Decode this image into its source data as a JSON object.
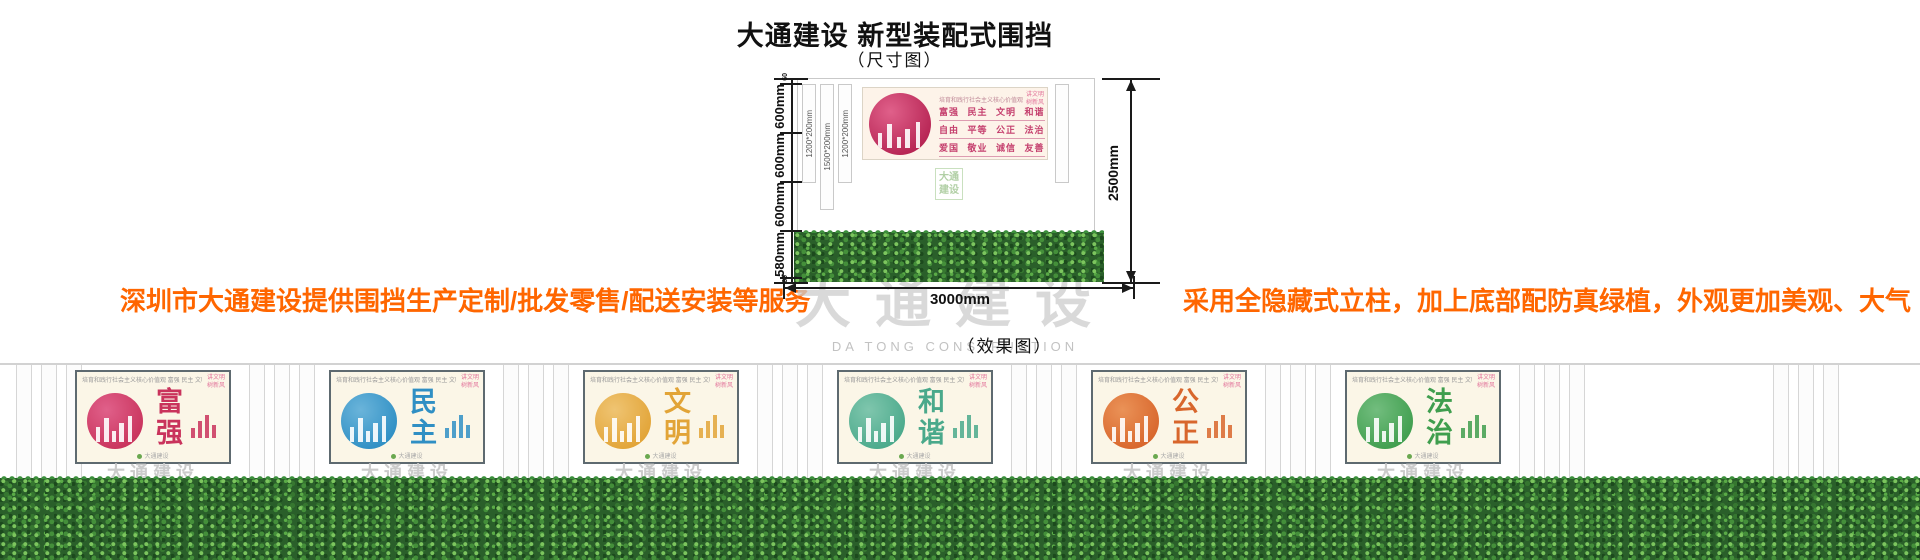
{
  "header": {
    "title": "大通建设 新型装配式围挡",
    "dim_label": "（尺寸图）"
  },
  "notes": {
    "left": "深圳市大通建设提供围挡生产定制/批发零售/配送安装等服务",
    "right": "采用全隐藏式立柱，加上底部配防真绿植，外观更加美观、大气"
  },
  "colors": {
    "accent_orange": "#ff6600",
    "values_pink": "#c5406e",
    "hedge_green": "#2a5f2a"
  },
  "dimension_figure": {
    "post_labels": [
      "1200*200mm",
      "1500*200mm",
      "1200*200mm"
    ],
    "seg_labels": [
      "600mm",
      "600mm",
      "600mm",
      "580mm"
    ],
    "tiny_seg_label": "60",
    "height_label": "2500mm",
    "width_label": "3000mm",
    "banner": {
      "header": "培育和践行社会主义核心价值观",
      "corner_line1": "讲文明",
      "corner_line2": "树新风",
      "rows": [
        "富强 民主 文明 和谐",
        "自由 平等 公正 法治",
        "爱国 敬业 诚信 友善"
      ]
    },
    "logo_text": "大通建设"
  },
  "watermark": {
    "cn": "大通建设",
    "en": "DA TONG CONSTRUCTION"
  },
  "effect_figure": {
    "label": "（效果图）",
    "panel_header": "培育和践行社会主义核心价值观  富强 民主 文明 和谐 公正 法治 爱国 敬业 诚信 友善",
    "corner_line1": "讲文明",
    "corner_line2": "树新风",
    "panel_footer": "大通建设",
    "panel_watermark": "大通建设",
    "panels": [
      {
        "word": "富强",
        "color": "#c9335c",
        "color2": "#e0608a"
      },
      {
        "word": "民主",
        "color": "#2f8fc4",
        "color2": "#6ab4da"
      },
      {
        "word": "文明",
        "color": "#e2a437",
        "color2": "#efc472"
      },
      {
        "word": "和谐",
        "color": "#4aa98b",
        "color2": "#7fc6ad"
      },
      {
        "word": "公正",
        "color": "#d8662c",
        "color2": "#ea9257"
      },
      {
        "word": "法治",
        "color": "#3f9e4e",
        "color2": "#72bd7e"
      }
    ]
  }
}
